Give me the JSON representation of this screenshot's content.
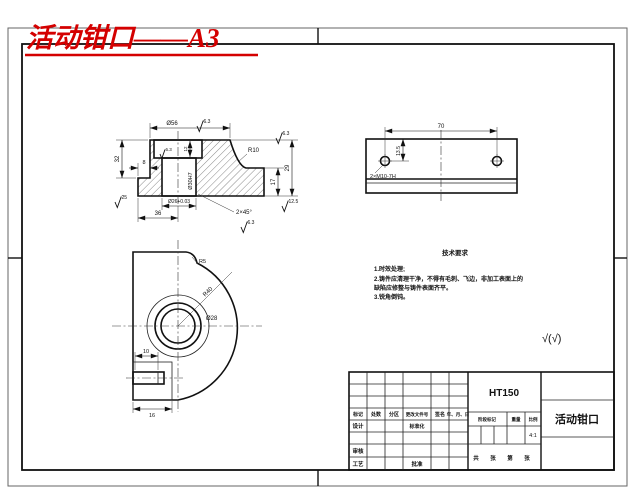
{
  "page": {
    "title_red": "活动钳口——A3"
  },
  "section_view": {
    "dim_top_diameter": "Ø56",
    "roughness_top": "6.3",
    "roughness_top_face": "6.3",
    "fillet_radius": "R10",
    "dim_total_height": "29",
    "dim_flange_height": "17",
    "roughness_bottom": "12.5",
    "chamfer_note": "2×45°",
    "roughness_chamfer": "6.3",
    "dim_bore": "Ø26+0.03",
    "dim_base_width": "36",
    "dim_left_height": "32",
    "dim_step_width": "8",
    "roughness_left": "25",
    "bore_label": "Ø30H7",
    "dim_counterbore_depth": "12",
    "roughness_counterbore": "6.3"
  },
  "plate_view": {
    "dim_hole_spacing": "70",
    "dim_hole_offset": "13.5",
    "hole_note": "2×M10-7H"
  },
  "front_view": {
    "fillet_radius": "R5",
    "outer_radius": "R40",
    "bore_diameter": "Ø28",
    "dim_slot_width": "10",
    "dim_slot_depth": "16"
  },
  "tech_requirements": {
    "title": "技术要求",
    "lines": [
      "1.时效处理;",
      "2.铸件应清理干净，不得有毛刺、飞边，非加工表面上的",
      "缺陷应修整与铸件表面齐平。",
      "3.锐角倒钝。"
    ]
  },
  "surface_note": "√(√)",
  "title_block": {
    "material": "HT150",
    "part_name": "活动钳口",
    "scale_value": "4:1",
    "rev_headers": [
      "标记",
      "处数",
      "分区",
      "更改文件号",
      "签名",
      "年、月、日"
    ],
    "roles": {
      "design": "设计",
      "standardization": "标准化",
      "check": "审核",
      "process": "工艺",
      "approve": "批准"
    },
    "stage_headers": [
      "阶段标记",
      "重量",
      "比例"
    ],
    "sheet_note": "共 张 第 张"
  },
  "colors": {
    "accent_red": "#d40000",
    "line": "#1a1a1a"
  }
}
